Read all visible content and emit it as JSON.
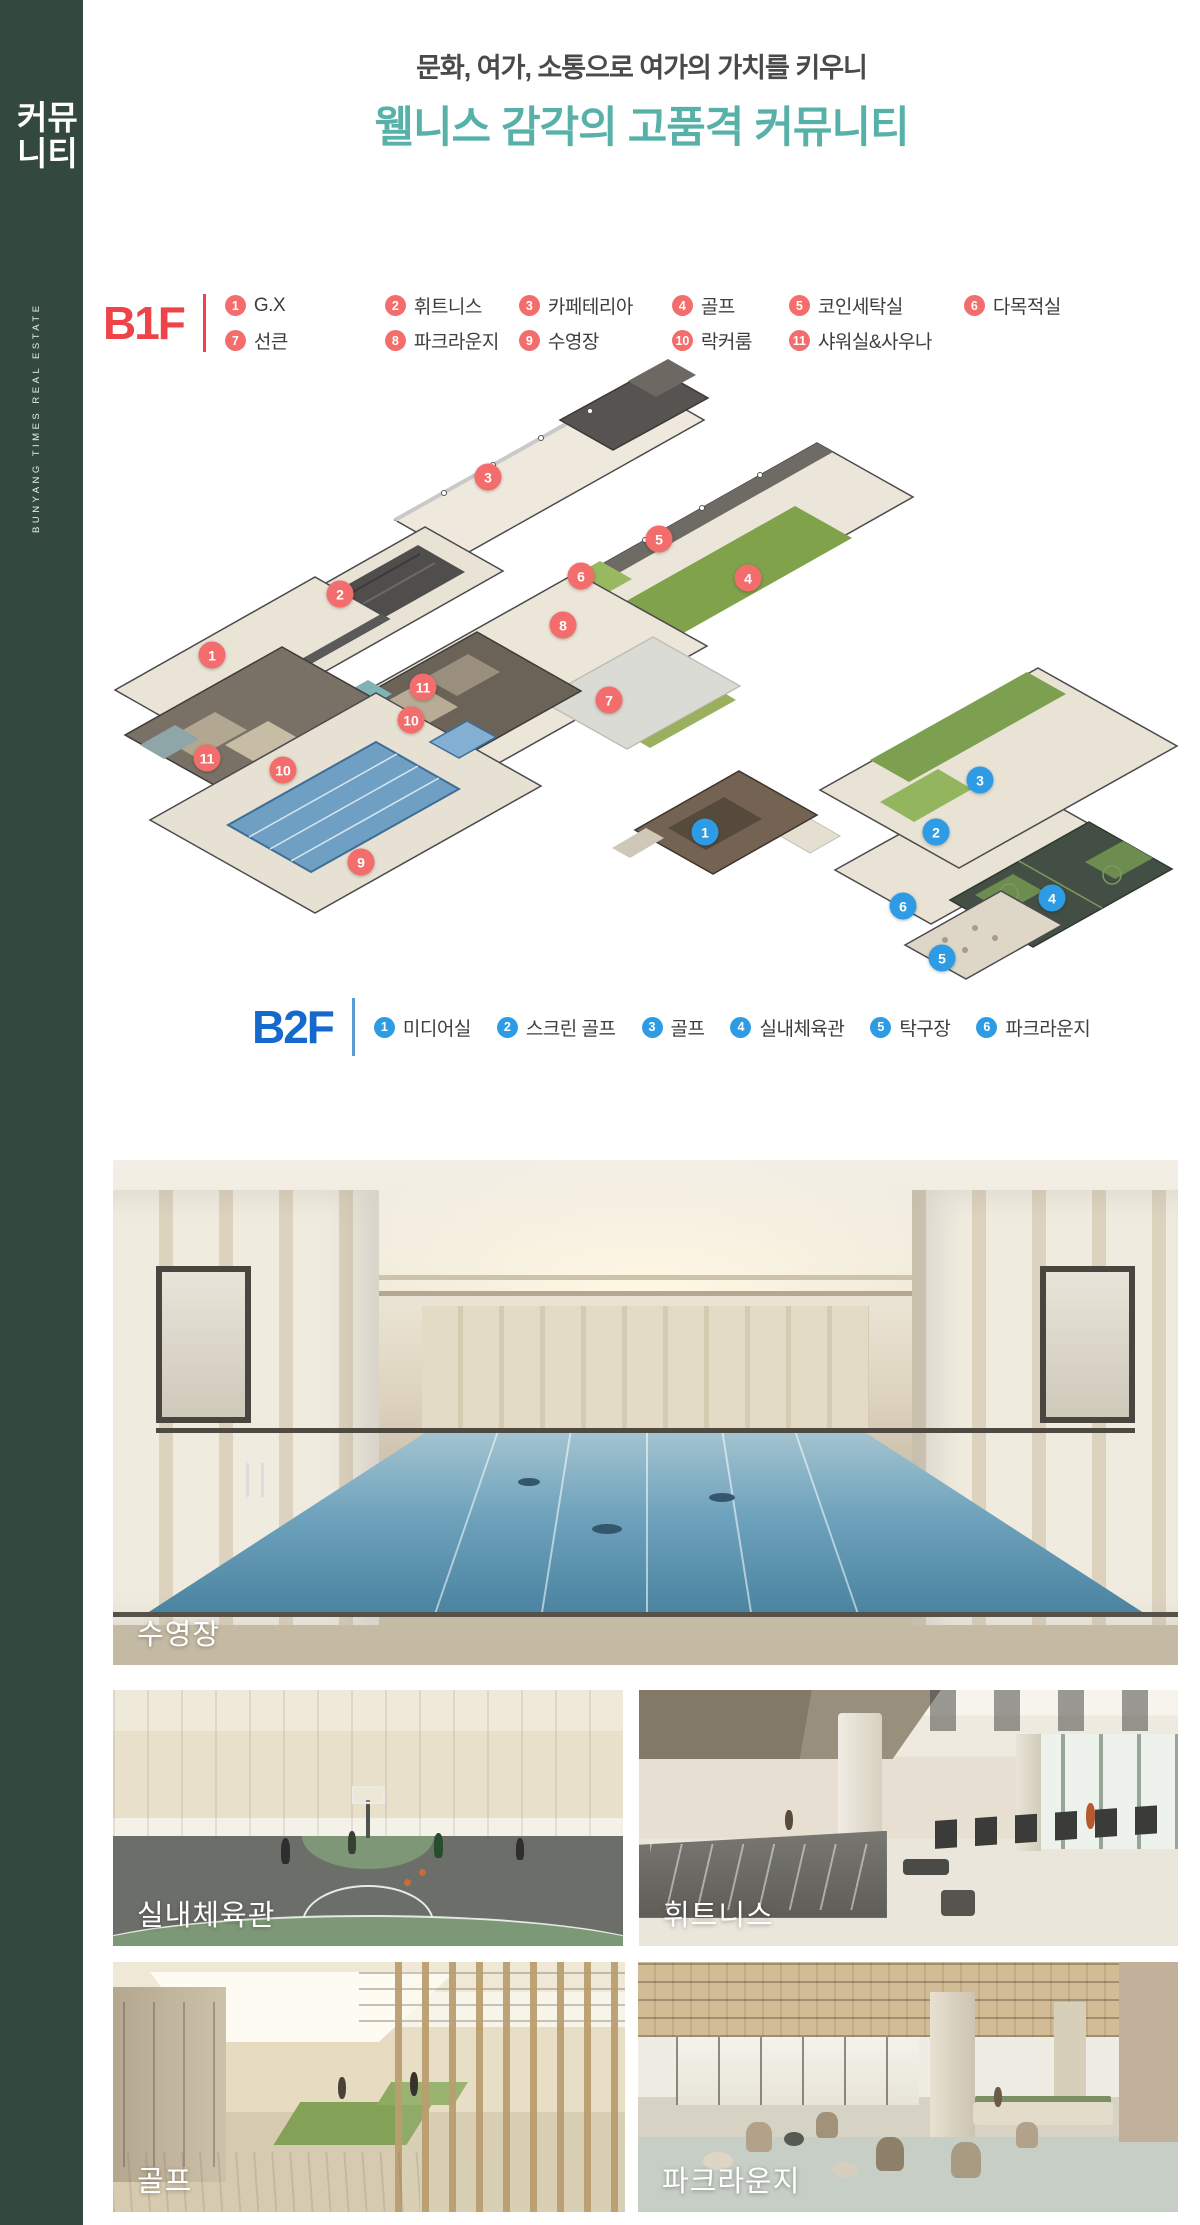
{
  "colors": {
    "sidebar_bg": "#33493d",
    "title_teal": "#57b1a8",
    "subtitle_gray": "#4a4a4a",
    "b1f_red": "#ee4348",
    "b1f_circle": "#f36d6d",
    "b2f_blue": "#1569cc",
    "b2f_divider": "#5b9bd5",
    "b2f_circle": "#2e9ce4"
  },
  "sidebar": {
    "tab_line1": "커뮤",
    "tab_line2": "니티",
    "vertical_text": "BUNYANG TIMES REAL ESTATE"
  },
  "header": {
    "subtitle": "문화, 여가, 소통으로 여가의 가치를 키우니",
    "title": "웰니스 감각의 고품격 커뮤니티"
  },
  "b1f": {
    "label": "B1F",
    "row1": [
      {
        "n": "1",
        "label": "G.X"
      },
      {
        "n": "2",
        "label": "휘트니스"
      },
      {
        "n": "3",
        "label": "카페테리아"
      },
      {
        "n": "4",
        "label": "골프"
      },
      {
        "n": "5",
        "label": "코인세탁실"
      },
      {
        "n": "6",
        "label": "다목적실"
      }
    ],
    "row2": [
      {
        "n": "7",
        "label": "선큰"
      },
      {
        "n": "8",
        "label": "파크라운지"
      },
      {
        "n": "9",
        "label": "수영장"
      },
      {
        "n": "10",
        "label": "락커룸"
      },
      {
        "n": "11",
        "label": "샤워실&사우나"
      }
    ]
  },
  "b2f": {
    "label": "B2F",
    "items": [
      {
        "n": "1",
        "label": "미디어실"
      },
      {
        "n": "2",
        "label": "스크린 골프"
      },
      {
        "n": "3",
        "label": "골프"
      },
      {
        "n": "4",
        "label": "실내체육관"
      },
      {
        "n": "5",
        "label": "탁구장"
      },
      {
        "n": "6",
        "label": "파크라운지"
      }
    ]
  },
  "plan": {
    "b1f_markers": [
      {
        "n": "1",
        "x": 212,
        "y": 655
      },
      {
        "n": "2",
        "x": 340,
        "y": 594
      },
      {
        "n": "3",
        "x": 488,
        "y": 477
      },
      {
        "n": "4",
        "x": 748,
        "y": 578
      },
      {
        "n": "5",
        "x": 659,
        "y": 539
      },
      {
        "n": "6",
        "x": 581,
        "y": 576
      },
      {
        "n": "7",
        "x": 609,
        "y": 700
      },
      {
        "n": "8",
        "x": 563,
        "y": 625
      },
      {
        "n": "9",
        "x": 361,
        "y": 862
      },
      {
        "n": "10",
        "x": 411,
        "y": 720
      },
      {
        "n": "10",
        "x": 283,
        "y": 770
      },
      {
        "n": "11",
        "x": 423,
        "y": 687
      },
      {
        "n": "11",
        "x": 207,
        "y": 758
      }
    ],
    "b2f_markers": [
      {
        "n": "1",
        "x": 705,
        "y": 832
      },
      {
        "n": "2",
        "x": 936,
        "y": 832
      },
      {
        "n": "3",
        "x": 980,
        "y": 780
      },
      {
        "n": "4",
        "x": 1052,
        "y": 898
      },
      {
        "n": "5",
        "x": 942,
        "y": 958
      },
      {
        "n": "6",
        "x": 903,
        "y": 906
      }
    ]
  },
  "photos": {
    "pool": {
      "label": "수영장"
    },
    "gym": {
      "label": "실내체육관"
    },
    "fitness": {
      "label": "휘트니스"
    },
    "golf": {
      "label": "골프"
    },
    "lounge": {
      "label": "파크라운지"
    }
  }
}
